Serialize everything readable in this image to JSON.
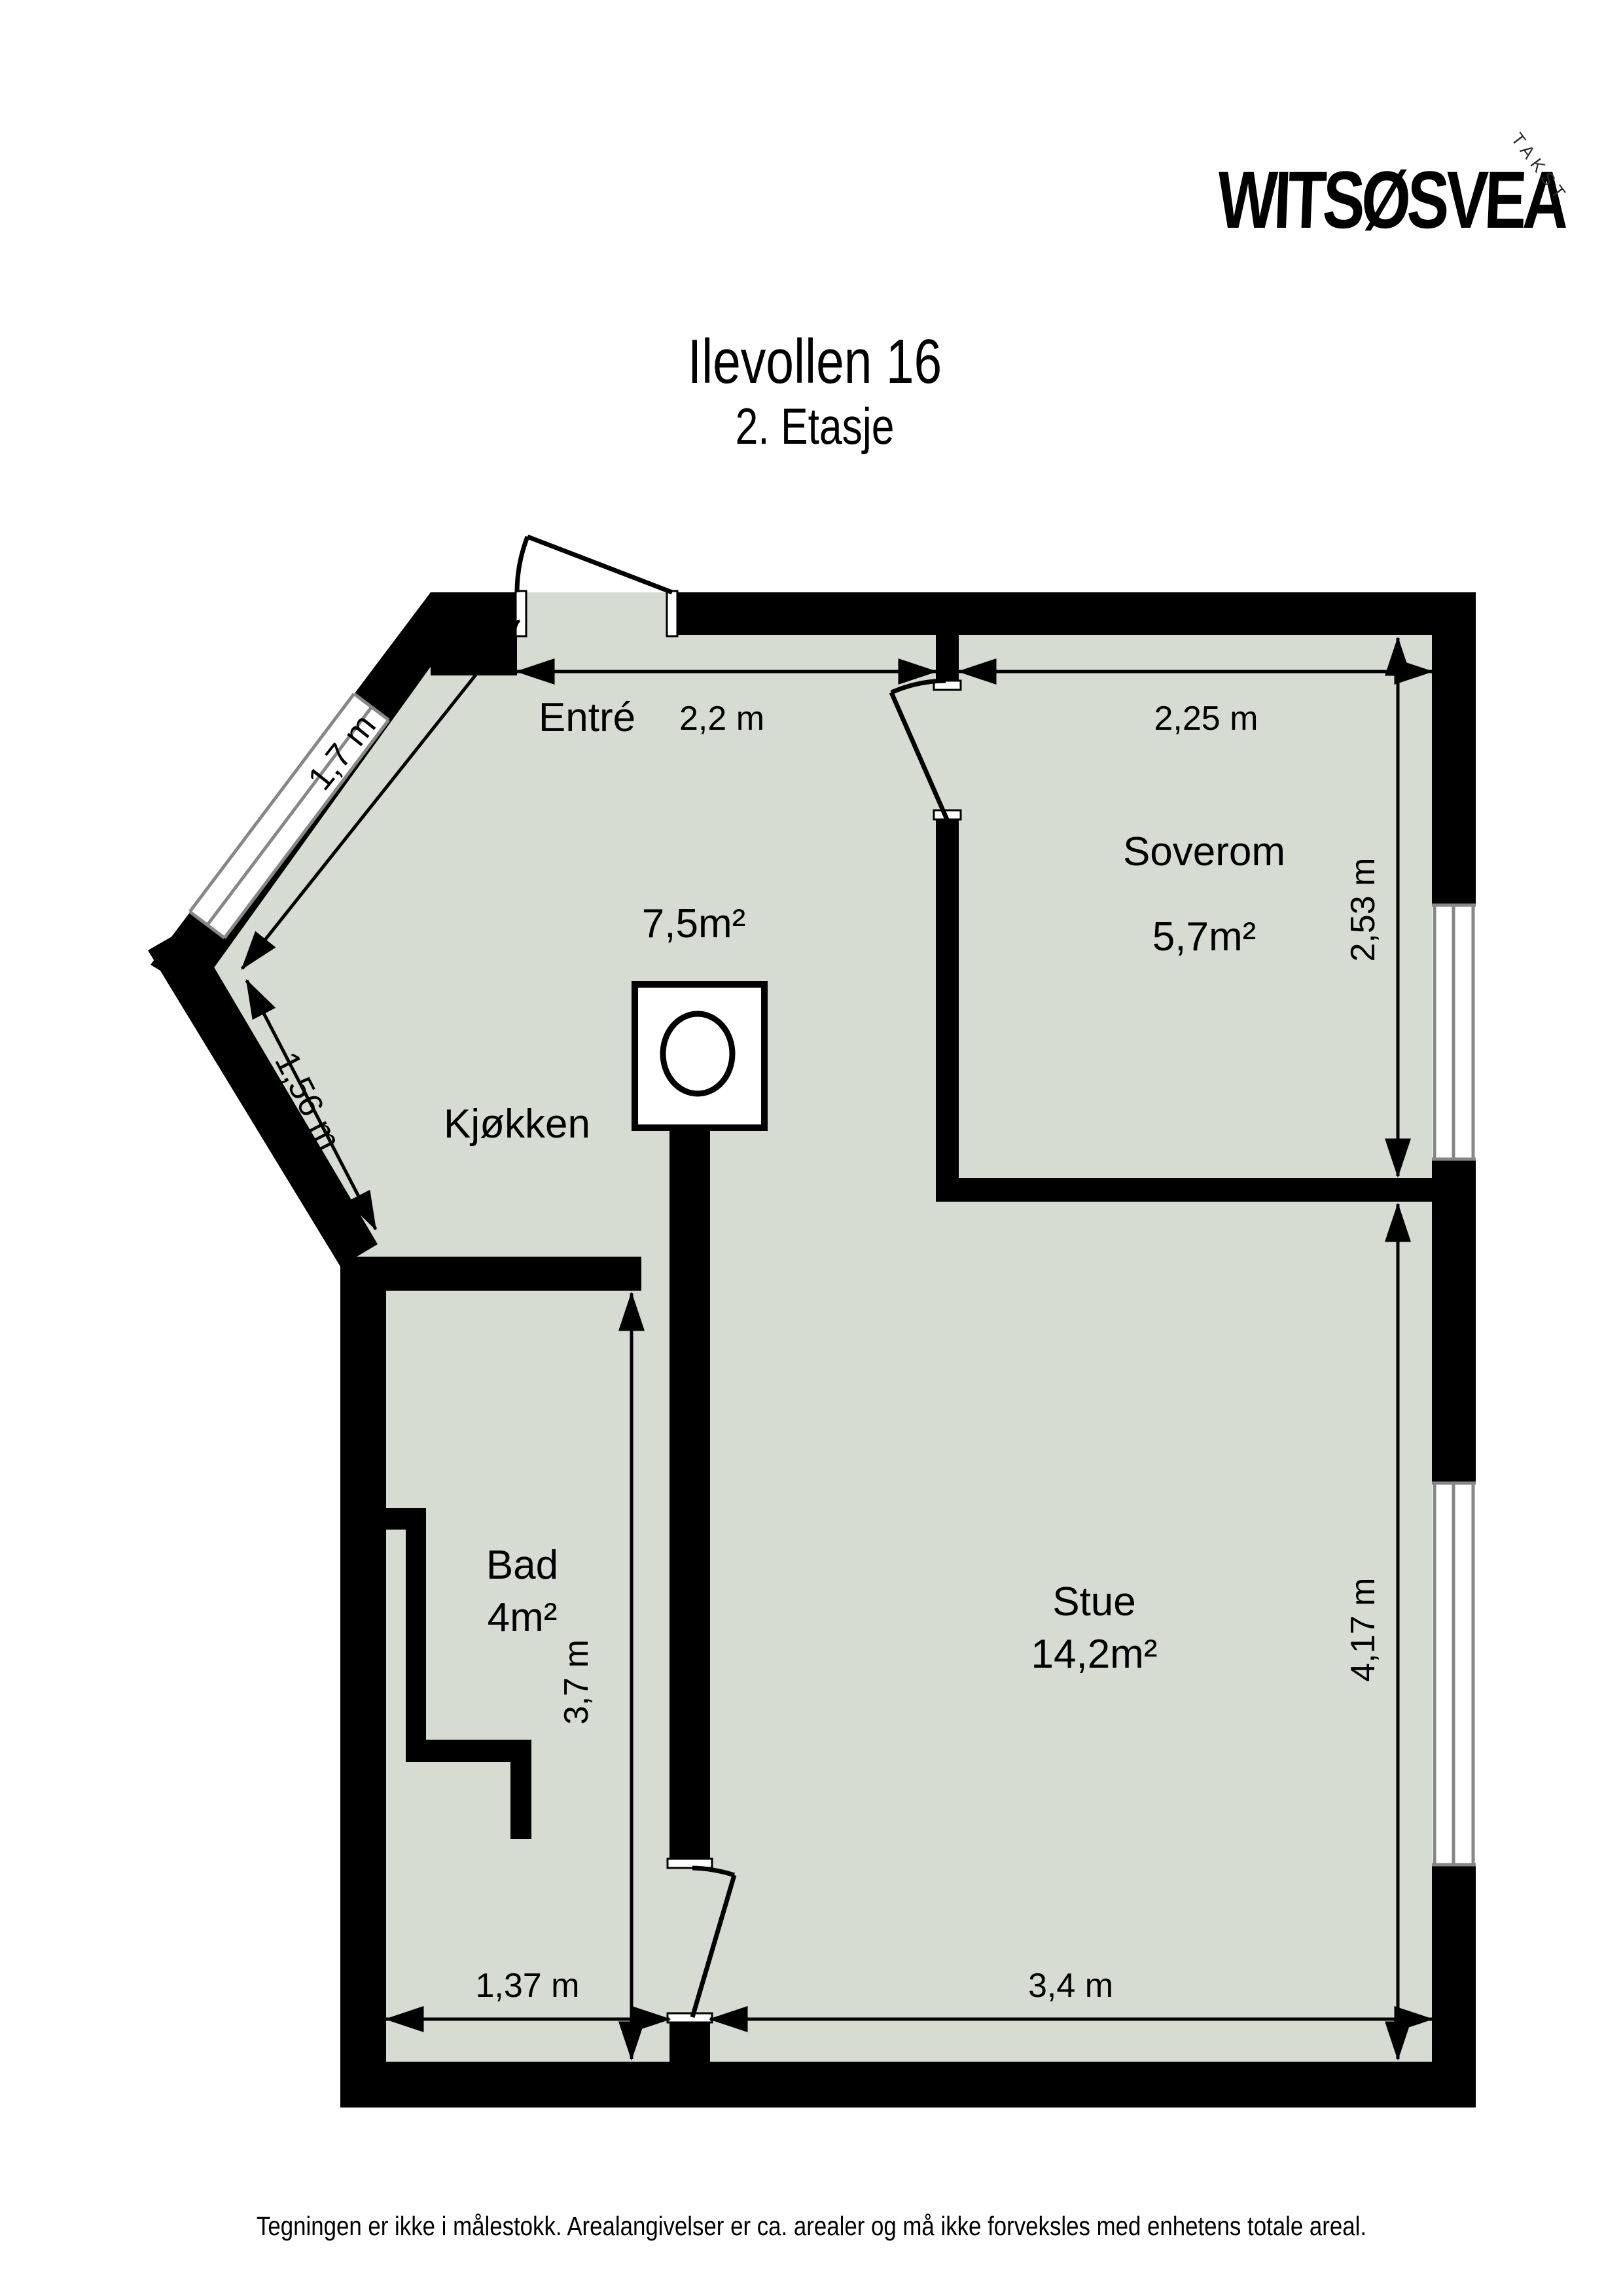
{
  "page": {
    "title": "Ilevollen 16",
    "subtitle": "2. Etasje",
    "footer": "Tegningen er ikke i målestokk. Arealangivelser er ca. arealer og må ikke forveksles med enhetens totale areal."
  },
  "logo": {
    "brand": "WITSØSVEA",
    "tagline": "TAKST"
  },
  "colors": {
    "floor": "#d6dcd2",
    "wall": "#000000",
    "window_frame": "#878787",
    "logo_gradient_start": "#ababab",
    "logo_gradient_end": "#3f3f3f"
  },
  "rooms": {
    "entre": {
      "label": "Entré"
    },
    "kjokken": {
      "label": "Kjøkken",
      "area": "7,5m²"
    },
    "soverom": {
      "label": "Soverom",
      "area": "5,7m²"
    },
    "stue": {
      "label": "Stue",
      "area": "14,2m²"
    },
    "bad": {
      "label": "Bad",
      "area": "4m²"
    }
  },
  "dims": {
    "entre_width": "2,2 m",
    "soverom_width": "2,25 m",
    "soverom_height": "2,53 m",
    "diag_window": "1,7 m",
    "diag_wall": "1,56 m",
    "bad_height": "3,7 m",
    "stue_height": "4,17 m",
    "bad_width": "1,37 m",
    "stue_width": "3,4 m"
  }
}
